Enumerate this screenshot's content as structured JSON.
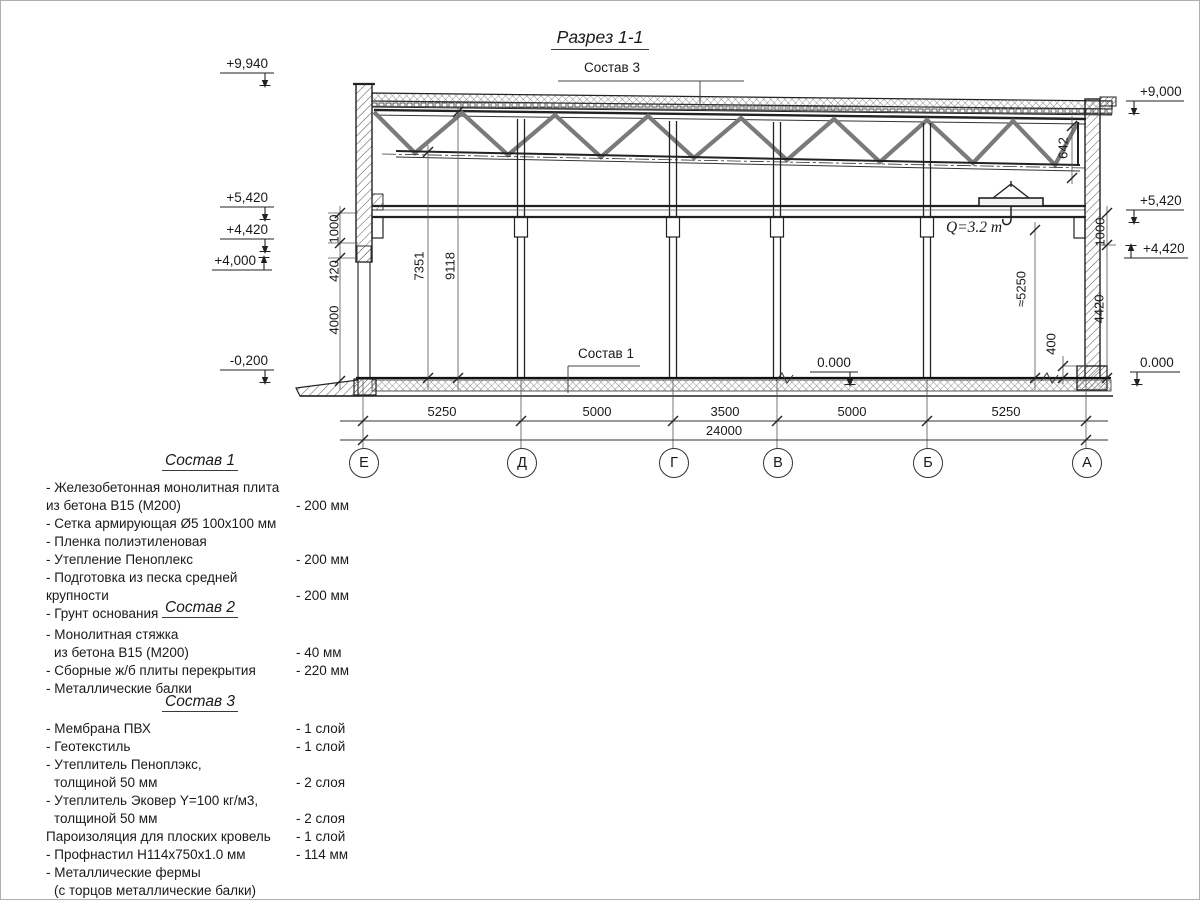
{
  "title": "Разрез 1-1",
  "section": {
    "leaders": {
      "sostav3": "Состав 3",
      "sostav1": "Состав 1"
    },
    "crane": {
      "label": "Q=3.2 т"
    },
    "elevations": {
      "left": [
        "+9,940",
        "+5,420",
        "+4,420",
        "+4,000",
        "-0,200"
      ],
      "right": [
        "+9,000",
        "+5,420",
        "+4,420",
        "0.000"
      ],
      "mid_floor": "0.000"
    },
    "vert_dims": {
      "left": [
        "1000",
        "420",
        "4000"
      ],
      "interior": [
        "7351",
        "9118"
      ],
      "right": [
        "642",
        "1000",
        "4420",
        "≈5250",
        "400"
      ]
    },
    "span_dims": [
      "5250",
      "5000",
      "3500",
      "5000",
      "5250"
    ],
    "total_span": "24000",
    "axes": [
      "Е",
      "Д",
      "Г",
      "В",
      "Б",
      "А"
    ]
  },
  "compositions": [
    {
      "title": "Состав 1",
      "items": [
        {
          "line1": "- Железобетонная  монолитная плита",
          "line2": "из бетона  В15 (М200)",
          "value": "- 200 мм"
        },
        {
          "line1": "- Сетка армирующая Ø5 100х100 мм",
          "line2": "",
          "value": ""
        },
        {
          "line1": "- Пленка полиэтиленовая",
          "line2": "",
          "value": ""
        },
        {
          "line1": "- Утепление Пеноплекс",
          "line2": "",
          "value": "- 200 мм"
        },
        {
          "line1": "- Подготовка из песка средней  крупности",
          "line2": "",
          "value": "- 200 мм"
        },
        {
          "line1": "- Грунт основания",
          "line2": "",
          "value": ""
        }
      ]
    },
    {
      "title": "Состав 2",
      "items": [
        {
          "line1": "- Монолитная стяжка",
          "line2": "из бетона В15 (М200)",
          "value": "- 40 мм"
        },
        {
          "line1": "- Сборные ж/б плиты перекрытия",
          "line2": "",
          "value": "- 220 мм"
        },
        {
          "line1": "- Металлические балки",
          "line2": "",
          "value": ""
        }
      ]
    },
    {
      "title": "Состав 3",
      "items": [
        {
          "line1": "- Мембрана ПВХ",
          "line2": "",
          "value": "- 1 слой"
        },
        {
          "line1": "- Геотекстиль",
          "line2": "",
          "value": "- 1 слой"
        },
        {
          "line1": "- Утеплитель Пеноплэкс,",
          "line2": "толщиной 50 мм",
          "value": "- 2 слоя"
        },
        {
          "line1": "- Утеплитель Эковер Y=100 кг/м3,",
          "line2": "толщиной 50 мм",
          "value": "- 2 слоя"
        },
        {
          "line1": "Пароизоляция для плоских кровель",
          "line2": "",
          "value": "- 1 слой"
        },
        {
          "line1": "- Профнастил Н114х750х1.0 мм",
          "line2": "",
          "value": "- 114 мм"
        },
        {
          "line1": "- Металлические фермы",
          "line2": "(с торцов металлические балки)",
          "value": ""
        }
      ]
    }
  ],
  "colors": {
    "line": "#1a1a1a",
    "hatch": "#555555",
    "background": "#ffffff"
  }
}
